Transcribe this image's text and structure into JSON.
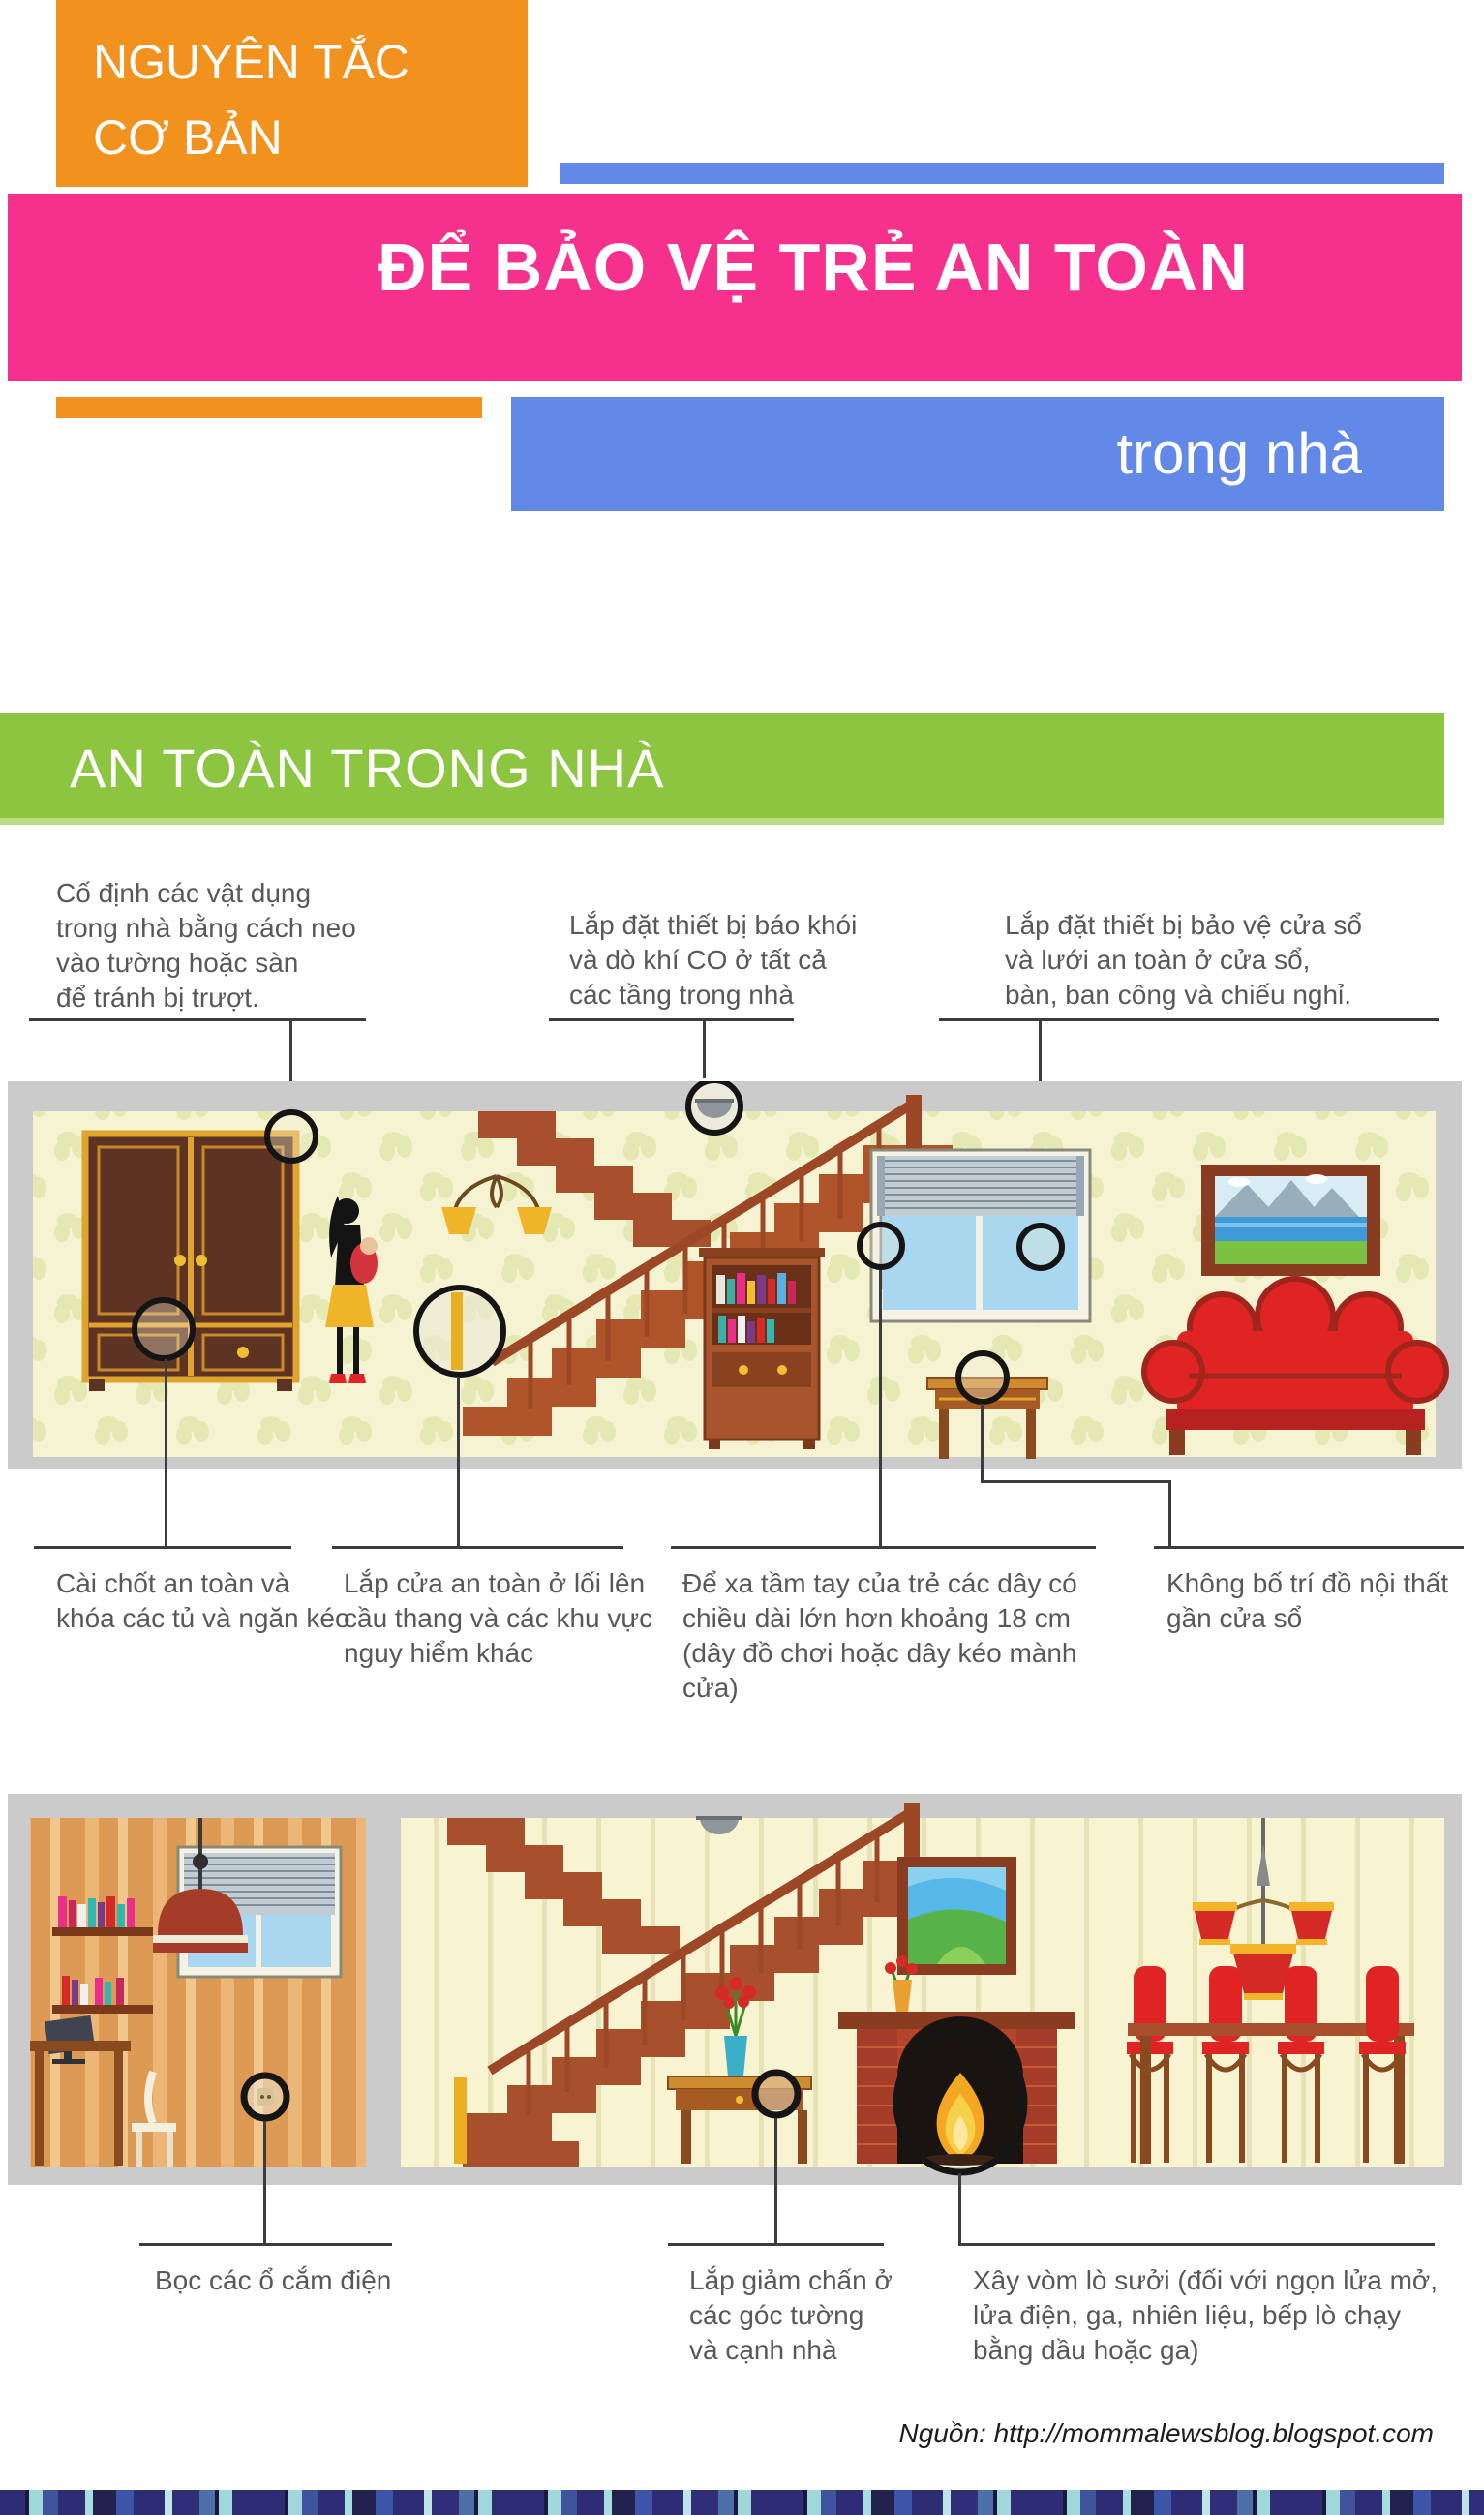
{
  "header": {
    "kicker": "NGUYÊN TẮC\nCƠ BẢN",
    "title": "ĐỂ BẢO VỆ TRẺ AN TOÀN",
    "subtitle": "trong nhà"
  },
  "section": {
    "title": "AN TOÀN TRONG NHÀ"
  },
  "annotations": {
    "anchor_furniture": "Cố định các vật dụng\ntrong nhà bằng cách neo\nvào tường hoặc sàn\nđể tránh bị trượt.",
    "smoke_detector": "Lắp đặt thiết bị báo khói\nvà dò khí CO ở tất cả\ncác tầng trong nhà",
    "window_guard": "Lắp đặt thiết bị bảo vệ cửa sổ\nvà lưới an toàn ở cửa sổ,\nbàn, ban công và chiếu nghỉ.",
    "cabinet_locks": "Cài chốt an toàn và\nkhóa các tủ và ngăn kéo",
    "safety_gate": "Lắp cửa an toàn ở lối lên\ncầu thang và các khu vực\nnguy hiểm khác",
    "cords": "Để xa tầm tay của trẻ các dây có\nchiều dài lớn hơn khoảng 18 cm\n(dây đồ chơi hoặc dây kéo mành cửa)",
    "furniture_window": "Không bố trí đồ nội thất\ngần cửa sổ",
    "outlet_covers": "Bọc các ổ cắm điện",
    "corner_guards": "Lắp giảm chấn ở\ncác góc tường\nvà cạnh nhà",
    "fireplace_screen": "Xây vòm lò sưởi (đối với ngọn lửa mở,\nlửa điện, ga, nhiên liệu, bếp lò chạy\nbằng dầu hoặc ga)"
  },
  "footer": {
    "source": "Nguồn: http://mommalewsblog.blogspot.com"
  },
  "colors": {
    "orange": "#F2921E",
    "pink": "#F5318D",
    "blue": "#6289E8",
    "green": "#8CC641",
    "annotation_text": "#57585a",
    "stairs_wood": "#A8502B",
    "sofa_red": "#E02423"
  }
}
